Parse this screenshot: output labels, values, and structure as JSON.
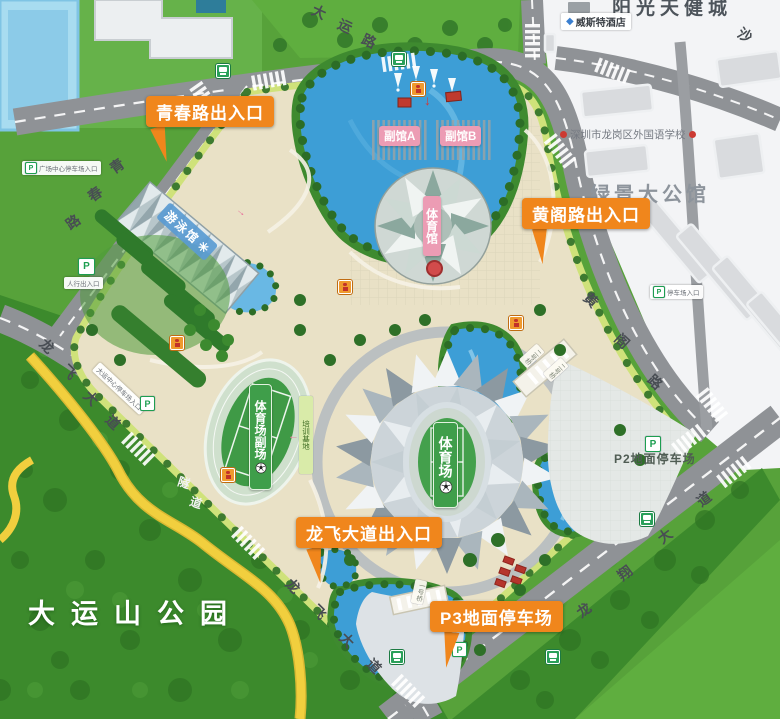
{
  "colors": {
    "entrance_orange": "#f0861c",
    "venue_green": "#3f9e4a",
    "venue_pink": "#ec9cb4",
    "water_blue": "#3d9ed6",
    "road_gray": "#8f9296",
    "park_beige": "#e9e1c6",
    "forest_green": "#3c8a2c",
    "mountain_road_yellow": "#f1cf3e"
  },
  "park": {
    "name": "大运山公园",
    "tunnel": "隧道"
  },
  "roads": {
    "dayun_road": "大运路",
    "qingchun_road": "青春路",
    "longfei_avenue": "龙飞大道",
    "longxiang_avenue": "龙翔大道",
    "huangge_road": "黄阁路",
    "sha_road": "沙",
    "bridge_1": "一号桥",
    "bridge_2": "二号桥"
  },
  "entrances": {
    "qingchun": "青春路出入口",
    "huangge": "黄阁路出入口",
    "longfei": "龙飞大道出入口"
  },
  "venues": {
    "stadium": "体育场",
    "stadium_annex": "体育场副场",
    "gymnasium": "体育馆",
    "natatorium": "游泳馆",
    "hall_a": "副馆A",
    "hall_b": "副馆B",
    "training_base": "培训基地"
  },
  "parking": {
    "p_letter": "P",
    "p2": "P2地面停车场",
    "p3": "P3地面停车场",
    "plaza_center_sign": "广场中心停车场入口",
    "pedestrian_sign": "人行出入口",
    "dayun_center_sign": "大运中心停车场入口",
    "east_sign": "停车场入口"
  },
  "city": {
    "sunshine_city": "阳光天健城",
    "hotel": "威斯特酒店",
    "school": "深圳市龙岗区外国语学校",
    "mansion": "绿景大公馆"
  },
  "icons": {
    "arrow_down": "↓",
    "arrow_left": "←",
    "arrow_right": "→"
  }
}
